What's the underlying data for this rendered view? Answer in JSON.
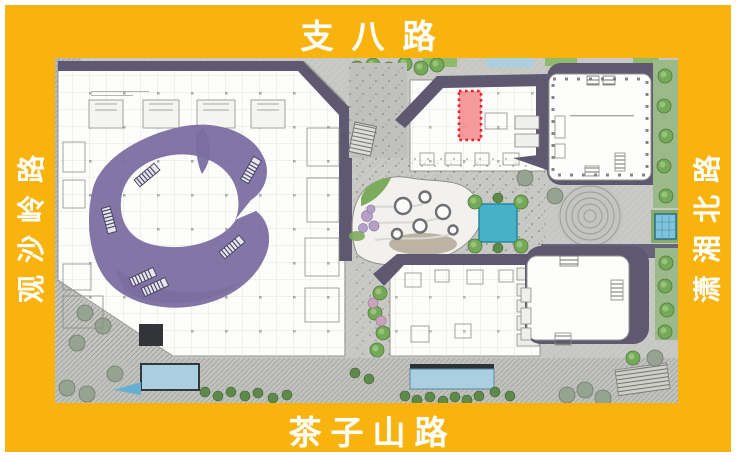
{
  "frame": {
    "color": "#F9B30E",
    "label_color": "#FFFFFF",
    "roads": {
      "top": "支八路",
      "bottom": "茶子山路",
      "left": "观沙岭路",
      "right": "潇湘北路"
    }
  },
  "plan": {
    "highlight_unit": {
      "border_color": "#E8212D",
      "fill_color": "#F58A8A",
      "border_style": "dotted"
    },
    "colors": {
      "paving": "#C9CAC5",
      "building": "#FDFDFB",
      "roof_shadow": "#5E5870",
      "atrium": "#7C6EA0",
      "water": "#45B2C8",
      "water_light": "#A9CFE0",
      "greenery": "#74A957"
    }
  }
}
